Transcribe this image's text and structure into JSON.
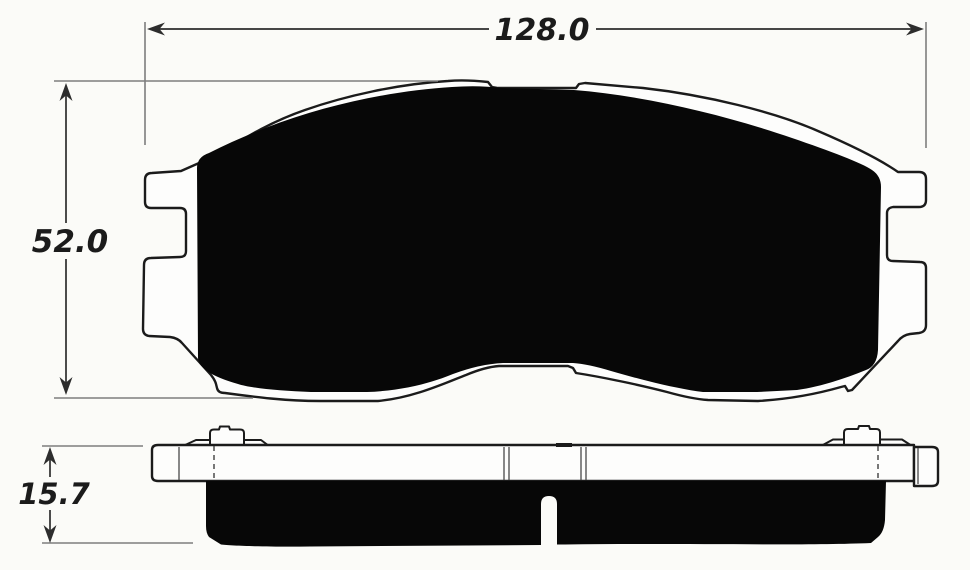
{
  "diagram": {
    "type": "technical-drawing",
    "dimension_labels": {
      "width": "128.0",
      "height": "52.0",
      "thickness": "15.7"
    },
    "colors": {
      "background": "#fbfbf8",
      "ink": "#1b1b1b",
      "friction_fill": "#070707",
      "plate_fill": "#fdfdfc",
      "extension_line": "#7e7e7e",
      "dimension_line": "#2d2d2d"
    }
  }
}
